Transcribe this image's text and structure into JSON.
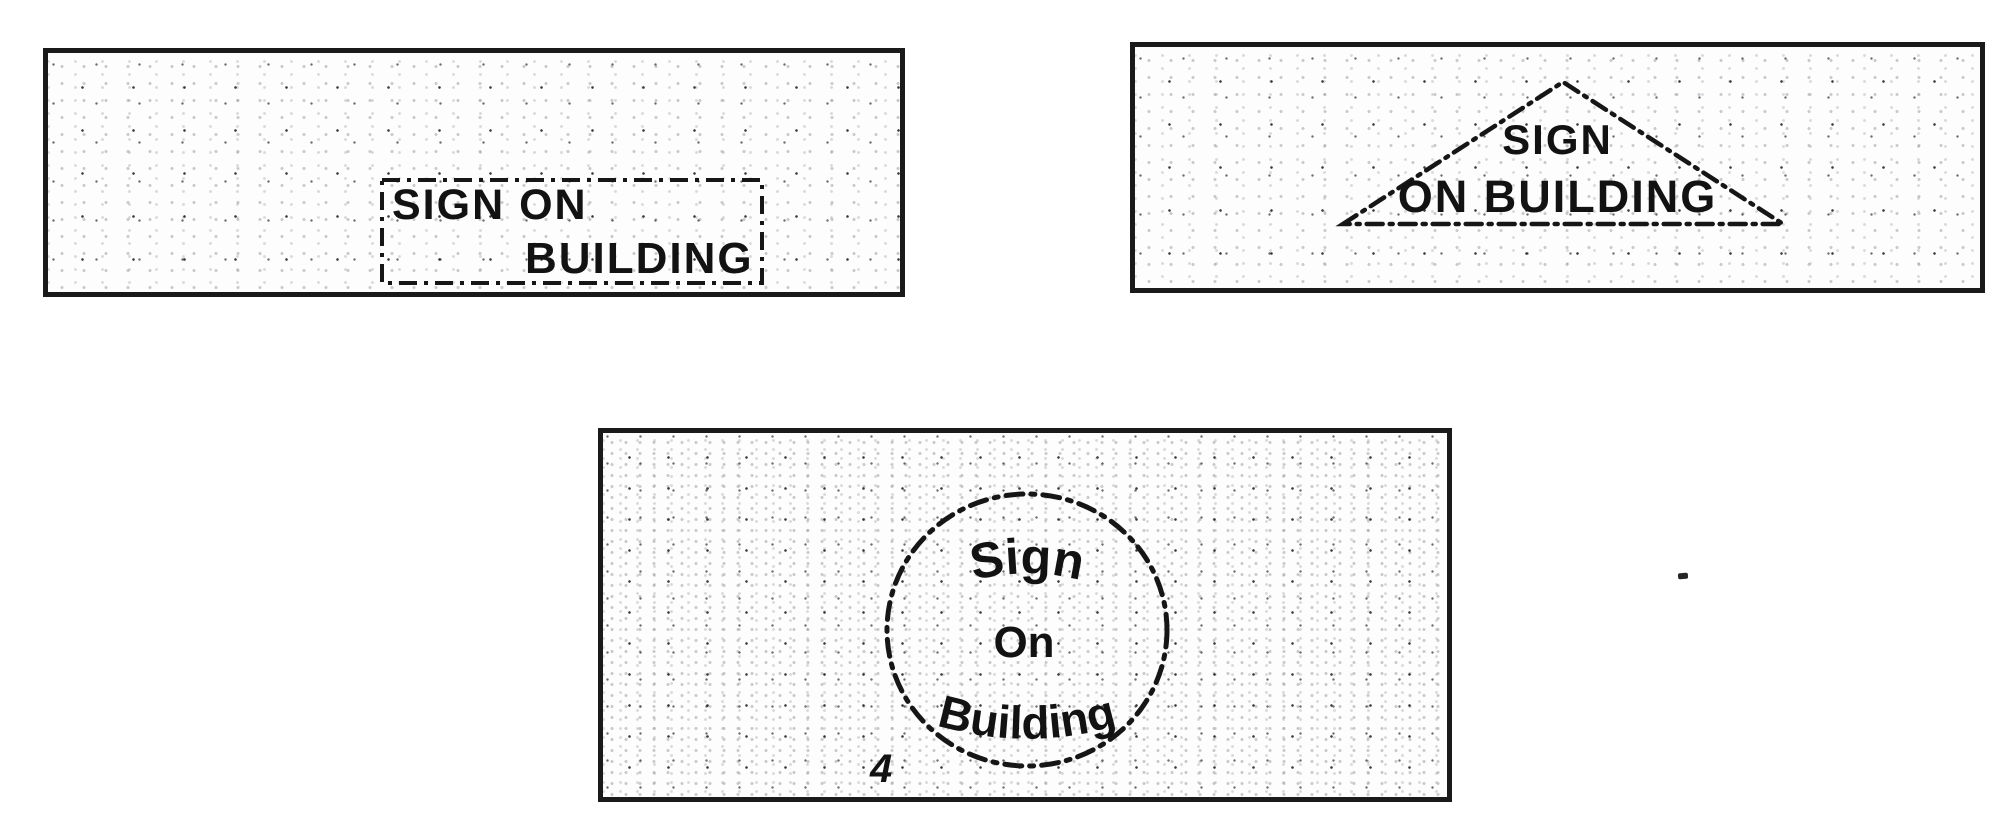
{
  "page": {
    "background_color": "#ffffff",
    "ink_color": "#121212",
    "description": "Scanned figure sheet with three sign-placement outline options"
  },
  "figure": {
    "panels": [
      {
        "id": "rectangle-option",
        "shape": "dash-dot-rectangle",
        "line1": "SIGN ON",
        "line2": "BUILDING"
      },
      {
        "id": "triangle-option",
        "shape": "dash-dot-triangle",
        "line1": "SIGN",
        "line2": "ON BUILDING"
      },
      {
        "id": "circle-option",
        "shape": "dash-dot-circle",
        "word_top": "Sign",
        "word_middle": "On",
        "word_bottom": "Building",
        "reference_numeral": "4"
      }
    ]
  }
}
